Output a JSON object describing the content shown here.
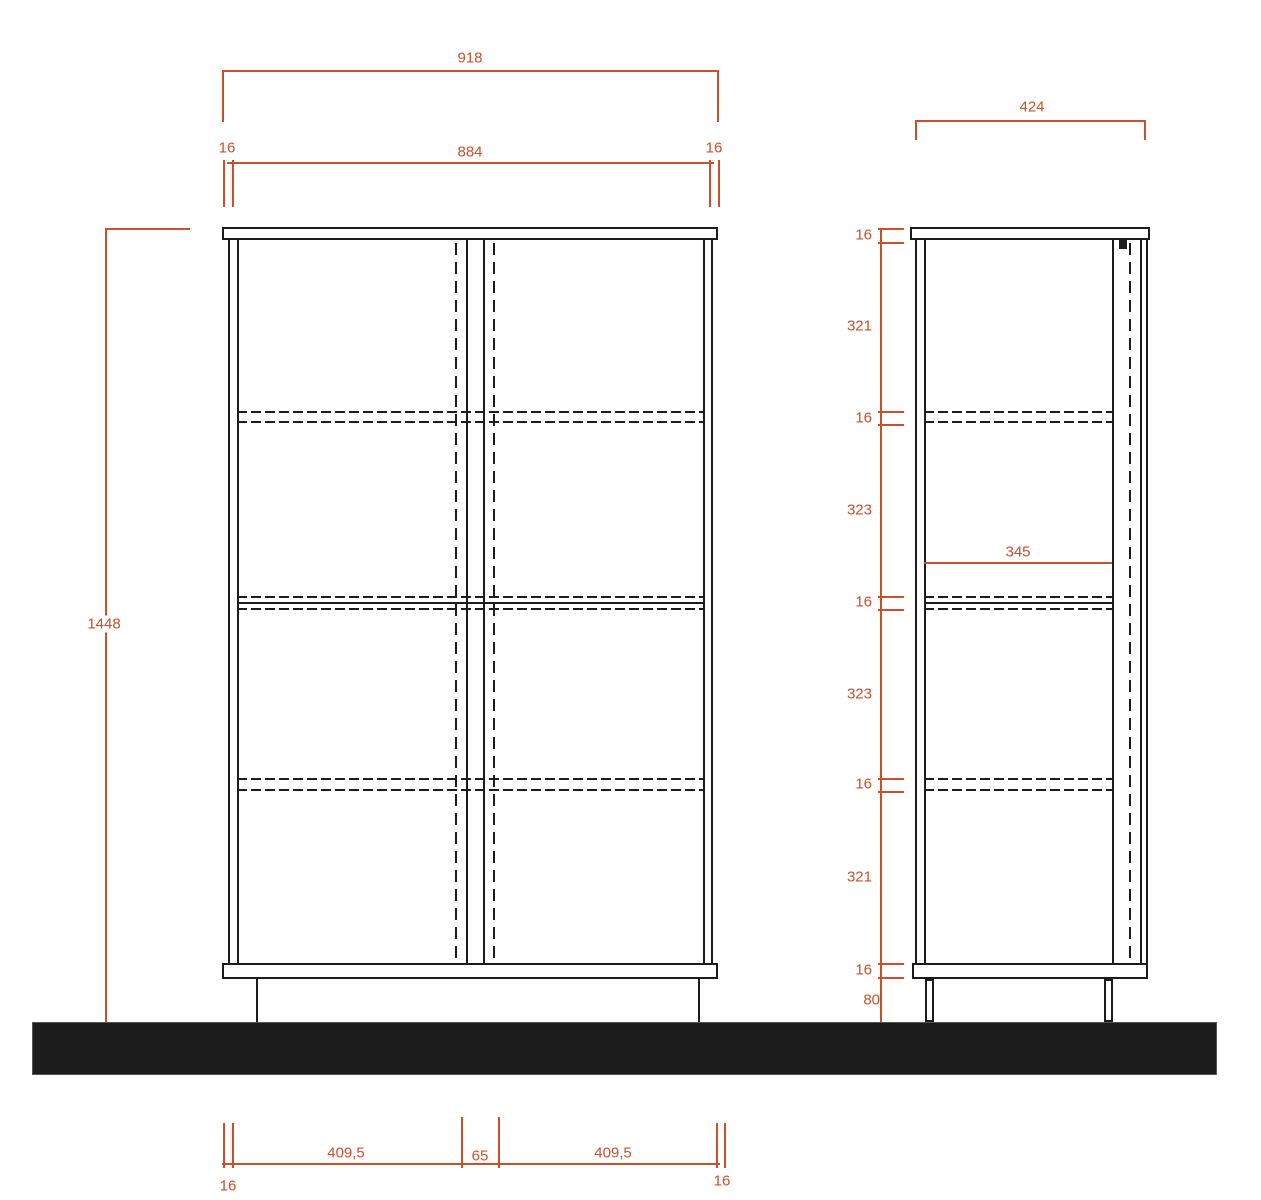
{
  "title": "cabinet-technical-drawing",
  "colors": {
    "dimension": "#c8502d",
    "linework": "#1c1c1c",
    "paper": "#ffffff",
    "floor": "#0e0e0e"
  },
  "front_view": {
    "overall_width": "918",
    "carcass_width": "884",
    "side_panel_left": "16",
    "side_panel_right": "16",
    "overall_height": "1448",
    "bottom_chain": {
      "left_panel": "16",
      "left_door": "409,5",
      "center_gap": "65",
      "right_door": "409,5",
      "right_panel": "16"
    }
  },
  "side_view": {
    "overall_depth": "424",
    "internal_depth": "345",
    "height_chain": [
      "16",
      "321",
      "16",
      "323",
      "16",
      "323",
      "16",
      "321",
      "16",
      "80"
    ]
  }
}
